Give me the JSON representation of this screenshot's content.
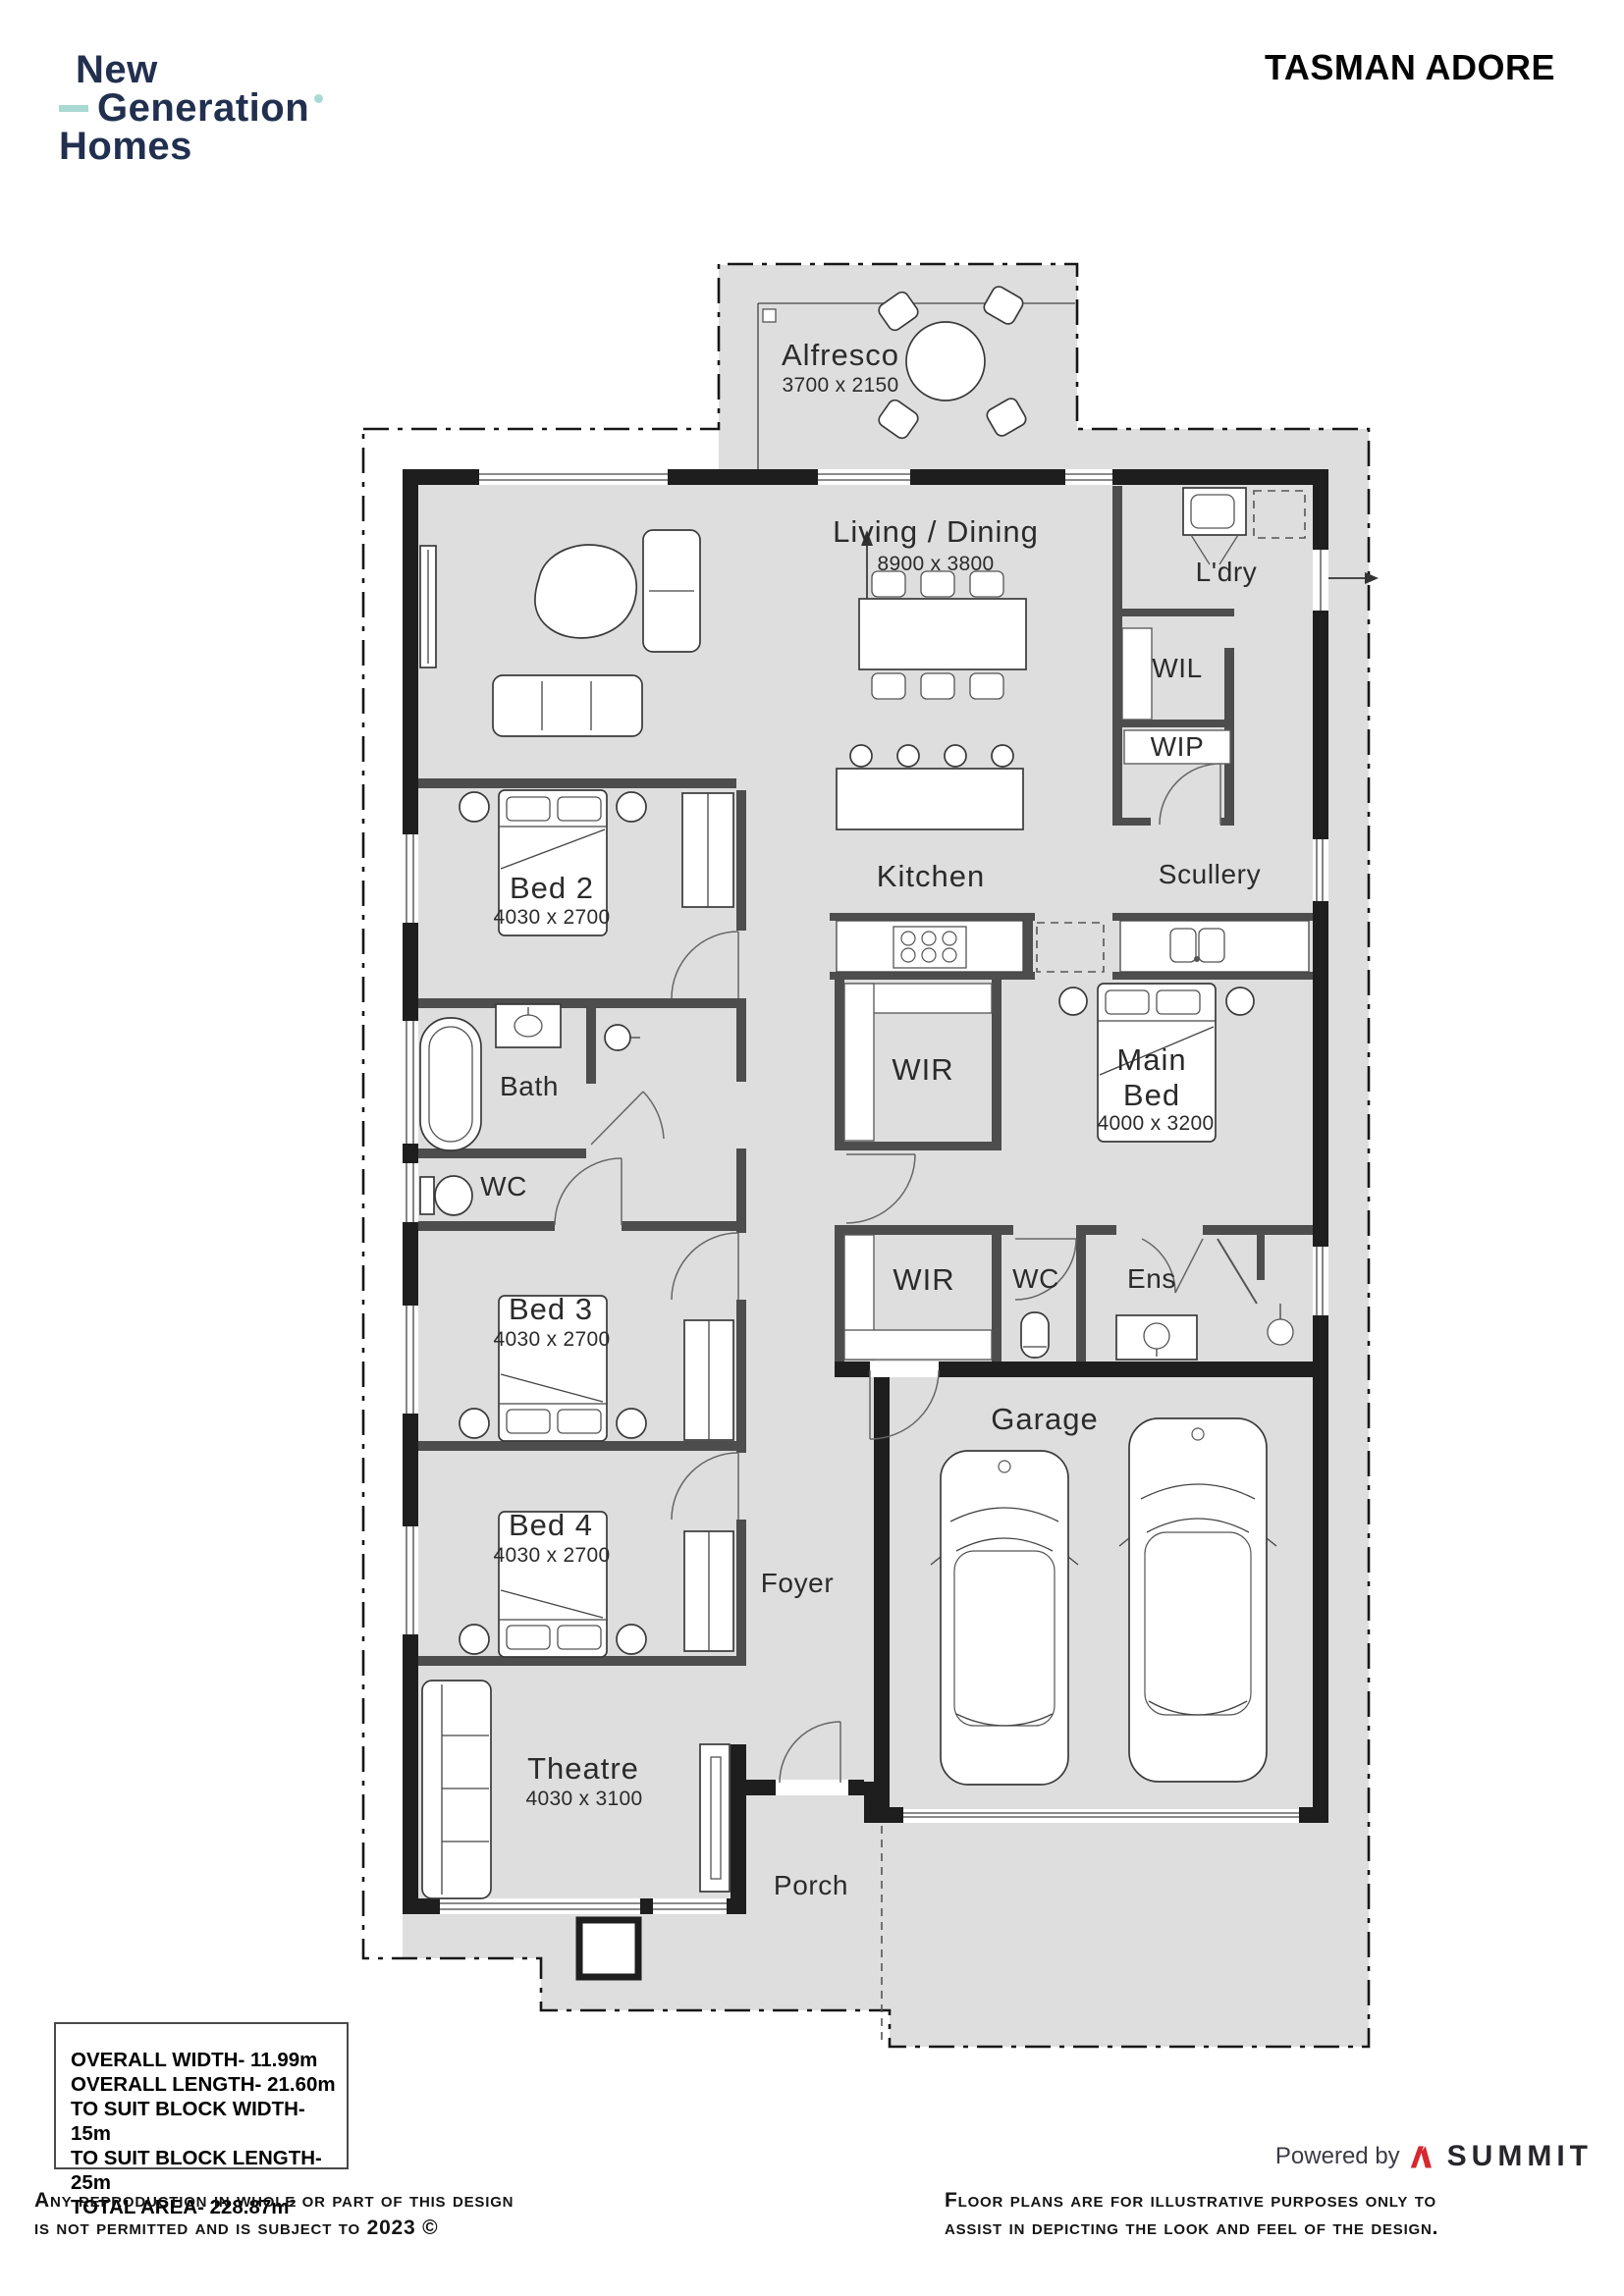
{
  "header": {
    "logo_line1": "New",
    "logo_line2": "Generation",
    "logo_line3": "Homes",
    "plan_title": "TASMAN ADORE"
  },
  "rooms": {
    "alfresco": {
      "name": "Alfresco",
      "dims": "3700 x 2150"
    },
    "living_dining": {
      "name": "Living / Dining",
      "dims": "8900 x 3800"
    },
    "laundry": {
      "name": "L'dry"
    },
    "wil": {
      "name": "WIL"
    },
    "wip": {
      "name": "WIP"
    },
    "kitchen": {
      "name": "Kitchen"
    },
    "scullery": {
      "name": "Scullery"
    },
    "bed2": {
      "name": "Bed 2",
      "dims": "4030 x 2700"
    },
    "bath": {
      "name": "Bath"
    },
    "wc": {
      "name": "WC"
    },
    "wir_main": {
      "name": "WIR"
    },
    "main_bed": {
      "name_lines": [
        "Main",
        "Bed"
      ],
      "dims": "4000 x 3200"
    },
    "wir_hall": {
      "name": "WIR"
    },
    "wc_ens": {
      "name": "WC"
    },
    "ens": {
      "name": "Ens"
    },
    "bed3": {
      "name": "Bed 3",
      "dims": "4030 x 2700"
    },
    "bed4": {
      "name": "Bed 4",
      "dims": "4030 x 2700"
    },
    "foyer": {
      "name": "Foyer"
    },
    "garage": {
      "name": "Garage"
    },
    "theatre": {
      "name": "Theatre",
      "dims": "4030 x 3100"
    },
    "porch": {
      "name": "Porch"
    }
  },
  "specs": {
    "lines": [
      "OVERALL WIDTH- 11.99m",
      "OVERALL LENGTH- 21.60m",
      "TO SUIT BLOCK WIDTH- 15m",
      "TO SUIT BLOCK LENGTH- 25m",
      "TOTAL AREA- 228.87m²"
    ]
  },
  "footer": {
    "powered_by": "Powered by",
    "brand": "SUMMIT",
    "left_note_lines": [
      "Any reproduction in whole or part of this design",
      "is not permitted and is subject to 2023 ©"
    ],
    "right_note_lines": [
      "Floor plans are for illustrative purposes only to",
      "assist in depicting the look and feel of the design."
    ]
  },
  "colors": {
    "logo_navy": "#22304f",
    "logo_teal": "#a9d9d3",
    "summit_red": "#d7282f",
    "plan_gray": "#dedede",
    "wall_dark": "#1e1e1e"
  }
}
